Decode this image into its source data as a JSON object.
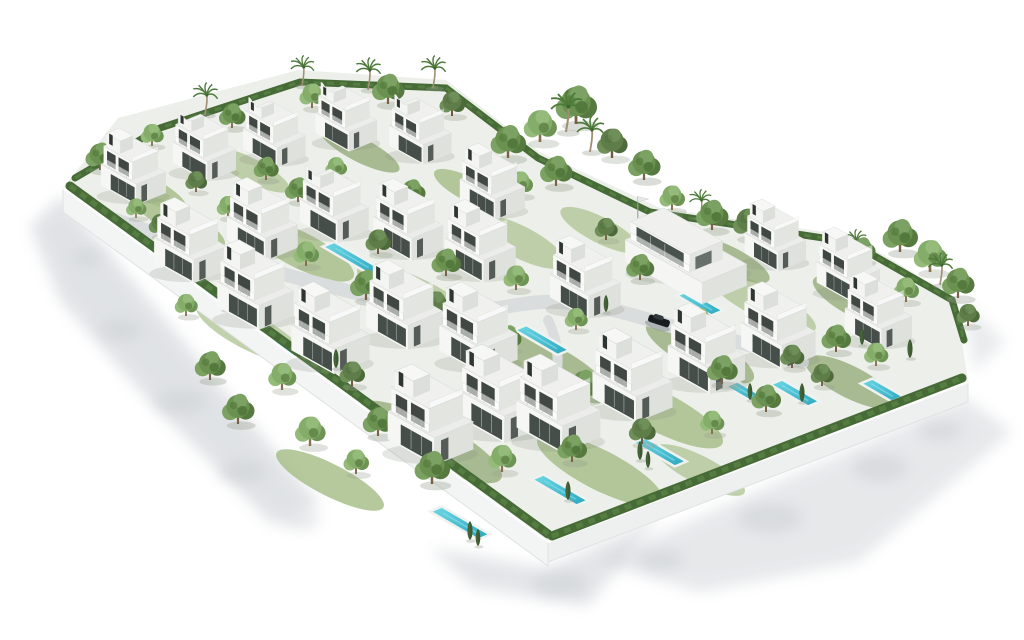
{
  "scene": {
    "description": "aerial-3d-render-of-white-villa-residential-development",
    "colors": {
      "background": "#ffffff",
      "shadow": "#c3c8cd",
      "plot": "#edf0ea",
      "lawn": [
        "#a3bb84",
        "#b2c597",
        "#96ad7a"
      ],
      "road": "#dadddd",
      "wallFrontLeft": "#f3f4f4",
      "wallFrontRight": "#eef0ef",
      "wallEdge": "#e0e3e3",
      "hedge": "#466b36",
      "hedgeLight": "#587f42",
      "poolDeck": "#f0f2ef",
      "poolHighlight": "#8ee0ea"
    },
    "iso": {
      "u": [
        0.86,
        0.5
      ],
      "v": [
        0.92,
        -0.38
      ],
      "poolWidth": 13
    },
    "plot": {
      "points": "63,188 118,118 298,70 446,80 540,152 660,208 852,236 956,298 968,382 548,542",
      "fill": "#edf0ea"
    },
    "walls": [
      {
        "points": "63,188 548,542 548,566 63,212",
        "fill": "#f3f4f4"
      },
      {
        "points": "548,542 968,382 968,402 548,562",
        "fill": "#eef0ef"
      }
    ],
    "wallHighlights": [
      {
        "d": "M63,188 L548,542"
      },
      {
        "d": "M548,542 L968,382"
      }
    ],
    "shadows": [
      {
        "points": "62,196 320,505 272,524 150,402 60,300 30,226",
        "op": 0.5
      },
      {
        "points": "430,548 548,568 660,516 588,606 474,588",
        "op": 0.45
      },
      {
        "points": "598,562 966,398 1012,432 858,562 700,592",
        "op": 0.4
      },
      {
        "points": "962,300 1006,342 974,372",
        "op": 0.35
      }
    ],
    "shadowBlobs": [
      [
        120,
        330,
        22
      ],
      [
        180,
        402,
        26
      ],
      [
        88,
        258,
        16
      ],
      [
        242,
        472,
        24
      ],
      [
        300,
        520,
        20
      ],
      [
        560,
        584,
        28
      ],
      [
        770,
        518,
        32
      ],
      [
        880,
        468,
        28
      ],
      [
        940,
        430,
        22
      ],
      [
        660,
        560,
        24
      ]
    ],
    "lawns": [
      [
        300,
        250,
        60,
        18
      ],
      [
        420,
        300,
        70,
        20
      ],
      [
        540,
        362,
        80,
        22
      ],
      [
        660,
        412,
        70,
        20
      ],
      [
        250,
        332,
        60,
        18
      ],
      [
        430,
        442,
        80,
        22
      ],
      [
        600,
        470,
        70,
        20
      ],
      [
        762,
        302,
        60,
        16
      ],
      [
        858,
        302,
        50,
        16
      ],
      [
        180,
        222,
        50,
        14
      ],
      [
        520,
        242,
        50,
        16
      ],
      [
        700,
        352,
        60,
        18
      ],
      [
        330,
        480,
        60,
        16
      ],
      [
        700,
        470,
        50,
        14
      ],
      [
        850,
        382,
        50,
        16
      ],
      [
        150,
        190,
        40,
        12
      ],
      [
        250,
        170,
        44,
        12
      ],
      [
        360,
        150,
        44,
        12
      ],
      [
        470,
        190,
        40,
        12
      ],
      [
        600,
        230,
        44,
        13
      ],
      [
        730,
        260,
        44,
        13
      ]
    ],
    "road": {
      "d": "M92,212 C210,252 330,294 438,308 C505,316 515,297 572,303 C625,309 648,322 700,333 C740,341 770,352 802,362",
      "width": 14,
      "branch": {
        "d": "M548,320 C560,345 560,368 552,392",
        "width": 10
      }
    },
    "hedges": [
      {
        "d": "M70,186 L548,534",
        "w": 9
      },
      {
        "d": "M552,536 L962,378",
        "w": 9
      },
      {
        "d": "M75,178 L160,128 L300,82 L446,88",
        "w": 7
      },
      {
        "d": "M446,88 L538,158 L650,212",
        "w": 7
      },
      {
        "d": "M650,212 L850,242 L952,300 L964,340",
        "w": 7
      }
    ],
    "pools": [
      [
        352,
        258,
        55
      ],
      [
        276,
        346,
        44
      ],
      [
        542,
        340,
        50
      ],
      [
        700,
        303,
        40
      ],
      [
        795,
        393,
        44
      ],
      [
        742,
        390,
        36
      ],
      [
        660,
        452,
        48
      ],
      [
        560,
        490,
        52
      ],
      [
        460,
        523,
        56
      ],
      [
        215,
        300,
        34
      ],
      [
        882,
        390,
        36
      ]
    ],
    "villas": [
      [
        133,
        195,
        0.7
      ],
      [
        492,
        210,
        0.7
      ],
      [
        190,
        272,
        0.78
      ],
      [
        262,
        250,
        0.76
      ],
      [
        408,
        250,
        0.75
      ],
      [
        480,
        272,
        0.76
      ],
      [
        585,
        308,
        0.76
      ],
      [
        255,
        318,
        0.82
      ],
      [
        330,
        362,
        0.84
      ],
      [
        404,
        338,
        0.82
      ],
      [
        478,
        362,
        0.84
      ],
      [
        430,
        452,
        0.92
      ],
      [
        500,
        430,
        0.9
      ],
      [
        558,
        440,
        0.9
      ],
      [
        632,
        410,
        0.86
      ],
      [
        706,
        382,
        0.83
      ],
      [
        778,
        358,
        0.8
      ],
      [
        775,
        262,
        0.66
      ],
      [
        848,
        292,
        0.68
      ],
      [
        878,
        340,
        0.72
      ]
    ],
    "villasCurved": [
      [
        204,
        172,
        0.68
      ],
      [
        274,
        158,
        0.67
      ],
      [
        346,
        142,
        0.66
      ],
      [
        420,
        155,
        0.67
      ],
      [
        334,
        232,
        0.74
      ]
    ],
    "clubhouse": [
      690,
      272,
      0.9
    ],
    "car": {
      "x": 658,
      "y": 324,
      "s": 1,
      "rot": 18
    },
    "palms": [
      [
        205,
        115,
        0.9
      ],
      [
        302,
        86,
        0.85
      ],
      [
        368,
        90,
        0.9
      ],
      [
        433,
        88,
        0.9
      ],
      [
        566,
        132,
        1.15
      ],
      [
        590,
        152,
        1.0
      ],
      [
        700,
        218,
        0.8
      ],
      [
        940,
        285,
        0.9
      ],
      [
        855,
        258,
        0.8
      ]
    ],
    "cypresses": [
      [
        320,
        360,
        1
      ],
      [
        336,
        368,
        1
      ],
      [
        600,
        300,
        1
      ],
      [
        606,
        312,
        0.9
      ],
      [
        640,
        460,
        1
      ],
      [
        648,
        468,
        0.9
      ],
      [
        470,
        540,
        1
      ],
      [
        478,
        546,
        0.9
      ],
      [
        568,
        500,
        1
      ],
      [
        225,
        310,
        0.9
      ],
      [
        910,
        358,
        1
      ],
      [
        750,
        400,
        0.9
      ],
      [
        802,
        402,
        1
      ],
      [
        862,
        345,
        0.9
      ]
    ],
    "trees": [
      [
        100,
        170,
        1,
        1
      ],
      [
        152,
        146,
        0.9,
        2
      ],
      [
        232,
        128,
        0.9,
        1
      ],
      [
        312,
        108,
        1,
        2
      ],
      [
        388,
        104,
        1.1,
        1
      ],
      [
        452,
        116,
        1,
        3
      ],
      [
        508,
        158,
        1.2,
        1
      ],
      [
        540,
        142,
        1.3,
        2
      ],
      [
        576,
        124,
        1.4,
        1
      ],
      [
        612,
        158,
        1.2,
        3
      ],
      [
        644,
        180,
        1.1,
        1
      ],
      [
        520,
        196,
        1,
        2
      ],
      [
        556,
        186,
        1.1,
        1
      ],
      [
        672,
        210,
        1,
        2
      ],
      [
        712,
        230,
        1.1,
        1
      ],
      [
        748,
        238,
        1.2,
        3
      ],
      [
        782,
        252,
        1,
        2
      ],
      [
        900,
        252,
        1.2,
        1
      ],
      [
        930,
        272,
        1.3,
        2
      ],
      [
        958,
        298,
        1.1,
        1
      ],
      [
        968,
        326,
        0.9,
        3
      ],
      [
        906,
        302,
        1,
        2
      ],
      [
        862,
        262,
        0.9,
        1
      ],
      [
        160,
        236,
        0.9,
        3
      ],
      [
        228,
        218,
        0.9,
        2
      ],
      [
        298,
        202,
        0.9,
        1
      ],
      [
        238,
        292,
        1,
        1
      ],
      [
        306,
        266,
        1,
        2
      ],
      [
        378,
        254,
        1,
        3
      ],
      [
        446,
        276,
        1,
        1
      ],
      [
        516,
        290,
        1,
        2
      ],
      [
        366,
        300,
        1.1,
        1
      ],
      [
        436,
        316,
        1,
        3
      ],
      [
        186,
        316,
        0.9,
        2
      ],
      [
        256,
        306,
        0.95,
        1
      ],
      [
        210,
        380,
        1.05,
        1
      ],
      [
        282,
        390,
        1.1,
        2
      ],
      [
        352,
        386,
        1,
        3
      ],
      [
        308,
        350,
        0.95,
        1
      ],
      [
        238,
        424,
        1.1,
        1
      ],
      [
        310,
        446,
        1.2,
        2
      ],
      [
        378,
        436,
        1.05,
        1
      ],
      [
        446,
        428,
        1.1,
        3
      ],
      [
        514,
        414,
        1.05,
        2
      ],
      [
        584,
        400,
        1.1,
        1
      ],
      [
        652,
        392,
        1,
        2
      ],
      [
        722,
        384,
        1.05,
        1
      ],
      [
        792,
        368,
        0.95,
        3
      ],
      [
        432,
        484,
        1.2,
        1
      ],
      [
        502,
        472,
        1.1,
        2
      ],
      [
        572,
        462,
        1,
        1
      ],
      [
        642,
        444,
        1.05,
        3
      ],
      [
        712,
        434,
        0.95,
        2
      ],
      [
        766,
        412,
        1,
        1
      ],
      [
        356,
        474,
        1,
        2
      ],
      [
        836,
        352,
        1,
        1
      ],
      [
        822,
        386,
        0.9,
        3
      ],
      [
        876,
        366,
        0.95,
        2
      ],
      [
        508,
        350,
        0.9,
        1
      ],
      [
        576,
        330,
        0.9,
        2
      ],
      [
        482,
        240,
        0.9,
        3
      ],
      [
        412,
        204,
        0.9,
        1
      ],
      [
        336,
        178,
        0.85,
        2
      ],
      [
        266,
        180,
        0.85,
        1
      ],
      [
        196,
        192,
        0.85,
        3
      ],
      [
        136,
        218,
        0.8,
        2
      ],
      [
        640,
        280,
        0.95,
        1
      ],
      [
        700,
        330,
        0.9,
        2
      ],
      [
        606,
        240,
        0.9,
        3
      ],
      [
        672,
        255,
        0.9,
        1
      ]
    ]
  }
}
